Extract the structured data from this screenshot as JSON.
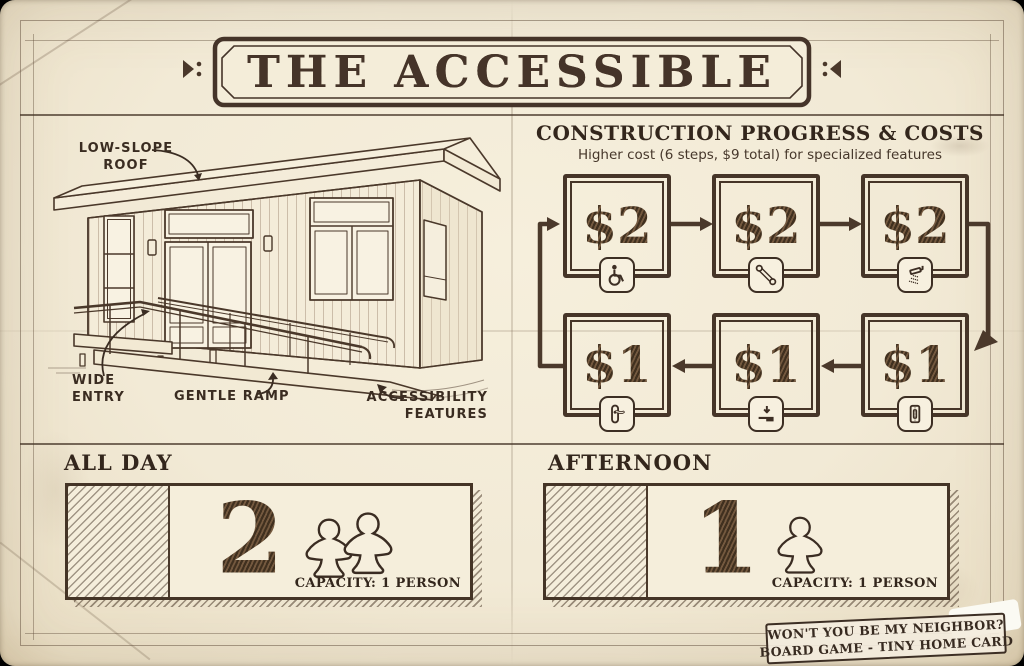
{
  "banner": {
    "title": "THE ACCESSIBLE"
  },
  "illustration": {
    "labels": {
      "roof": "LOW-SLOPE\nROOF",
      "entry": "WIDE\nENTRY",
      "ramp": "GENTLE RAMP",
      "features": "ACCESSIBILITY\nFEATURES"
    }
  },
  "construction": {
    "heading": "CONSTRUCTION PROGRESS & COSTS",
    "subheading": "Higher cost (6 steps, $9 total) for specialized features",
    "steps": [
      {
        "cost": "$2",
        "icon": "wheelchair-icon"
      },
      {
        "cost": "$2",
        "icon": "grab-bar-icon"
      },
      {
        "cost": "$2",
        "icon": "shower-icon"
      },
      {
        "cost": "$1",
        "icon": "door-handle-icon"
      },
      {
        "cost": "$1",
        "icon": "lowered-counter-icon"
      },
      {
        "cost": "$1",
        "icon": "light-switch-icon"
      }
    ],
    "flow": {
      "top_row": "left-to-right",
      "bottom_row": "right-to-left",
      "loop": true
    }
  },
  "schedule": {
    "all_day": {
      "label": "ALL DAY",
      "value": "2",
      "meeples": 2,
      "capacity": "CAPACITY: 1 PERSON"
    },
    "afternoon": {
      "label": "AFTERNOON",
      "value": "1",
      "meeples": 1,
      "capacity": "CAPACITY: 1 PERSON"
    }
  },
  "badge": {
    "line1": "WON'T YOU BE MY NEIGHBOR?",
    "line2": "BOARD GAME - TINY HOME CARD"
  },
  "colors": {
    "paper": "#f2ead6",
    "ink": "#43332a"
  }
}
